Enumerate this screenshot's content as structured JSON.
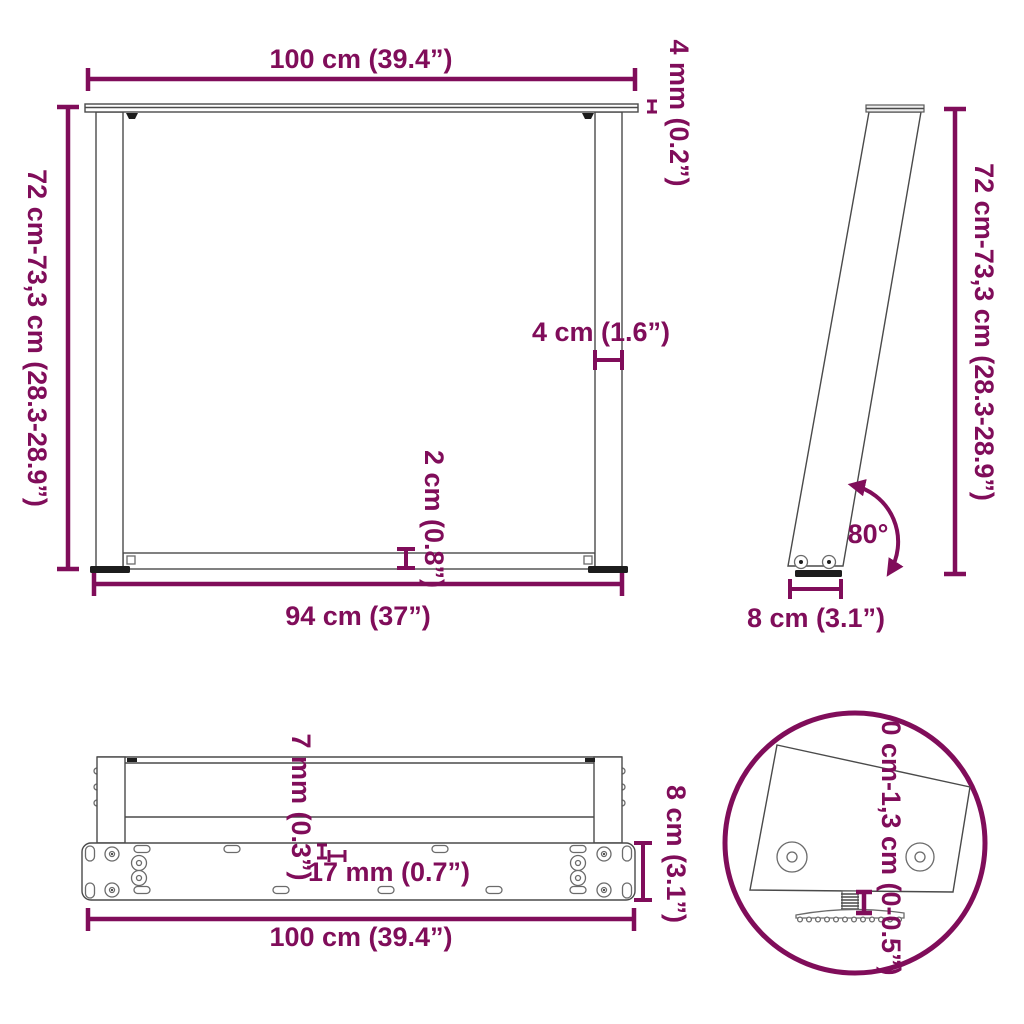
{
  "title": "table-leg-dimension-diagram",
  "colors": {
    "dimension": "#800D5A",
    "line": "#4a4a4a",
    "dark": "#1d1d1d",
    "background": "#ffffff"
  },
  "views": {
    "front": {
      "label": "front-view",
      "dims": {
        "top_width": "100 cm (39.4”)",
        "plate_thickness": "4 mm (0.2”)",
        "height_range": "72 cm-73,3 cm (28.3-28.9”)",
        "leg_width": "4 cm (1.6”)",
        "crossbar_thickness": "2 cm (0.8”)",
        "bottom_width": "94 cm (37”)"
      }
    },
    "side": {
      "label": "side-view",
      "dims": {
        "height_range": "72 cm-73,3 cm (28.3-28.9”)",
        "leg_angle": "80°",
        "foot_depth": "8 cm (3.1”)"
      }
    },
    "bottom": {
      "label": "bottom-view",
      "dims": {
        "bar_thickness": "7 mm (0.3”)",
        "hole_spacing": "17 mm (0.7”)",
        "plate_depth": "8 cm (3.1”)",
        "total_width": "100 cm (39.4”)"
      }
    },
    "detail": {
      "label": "adjustable-foot-detail",
      "dims": {
        "adjustment_range": "0 cm-1,3 cm (0-0.5”)"
      }
    }
  }
}
